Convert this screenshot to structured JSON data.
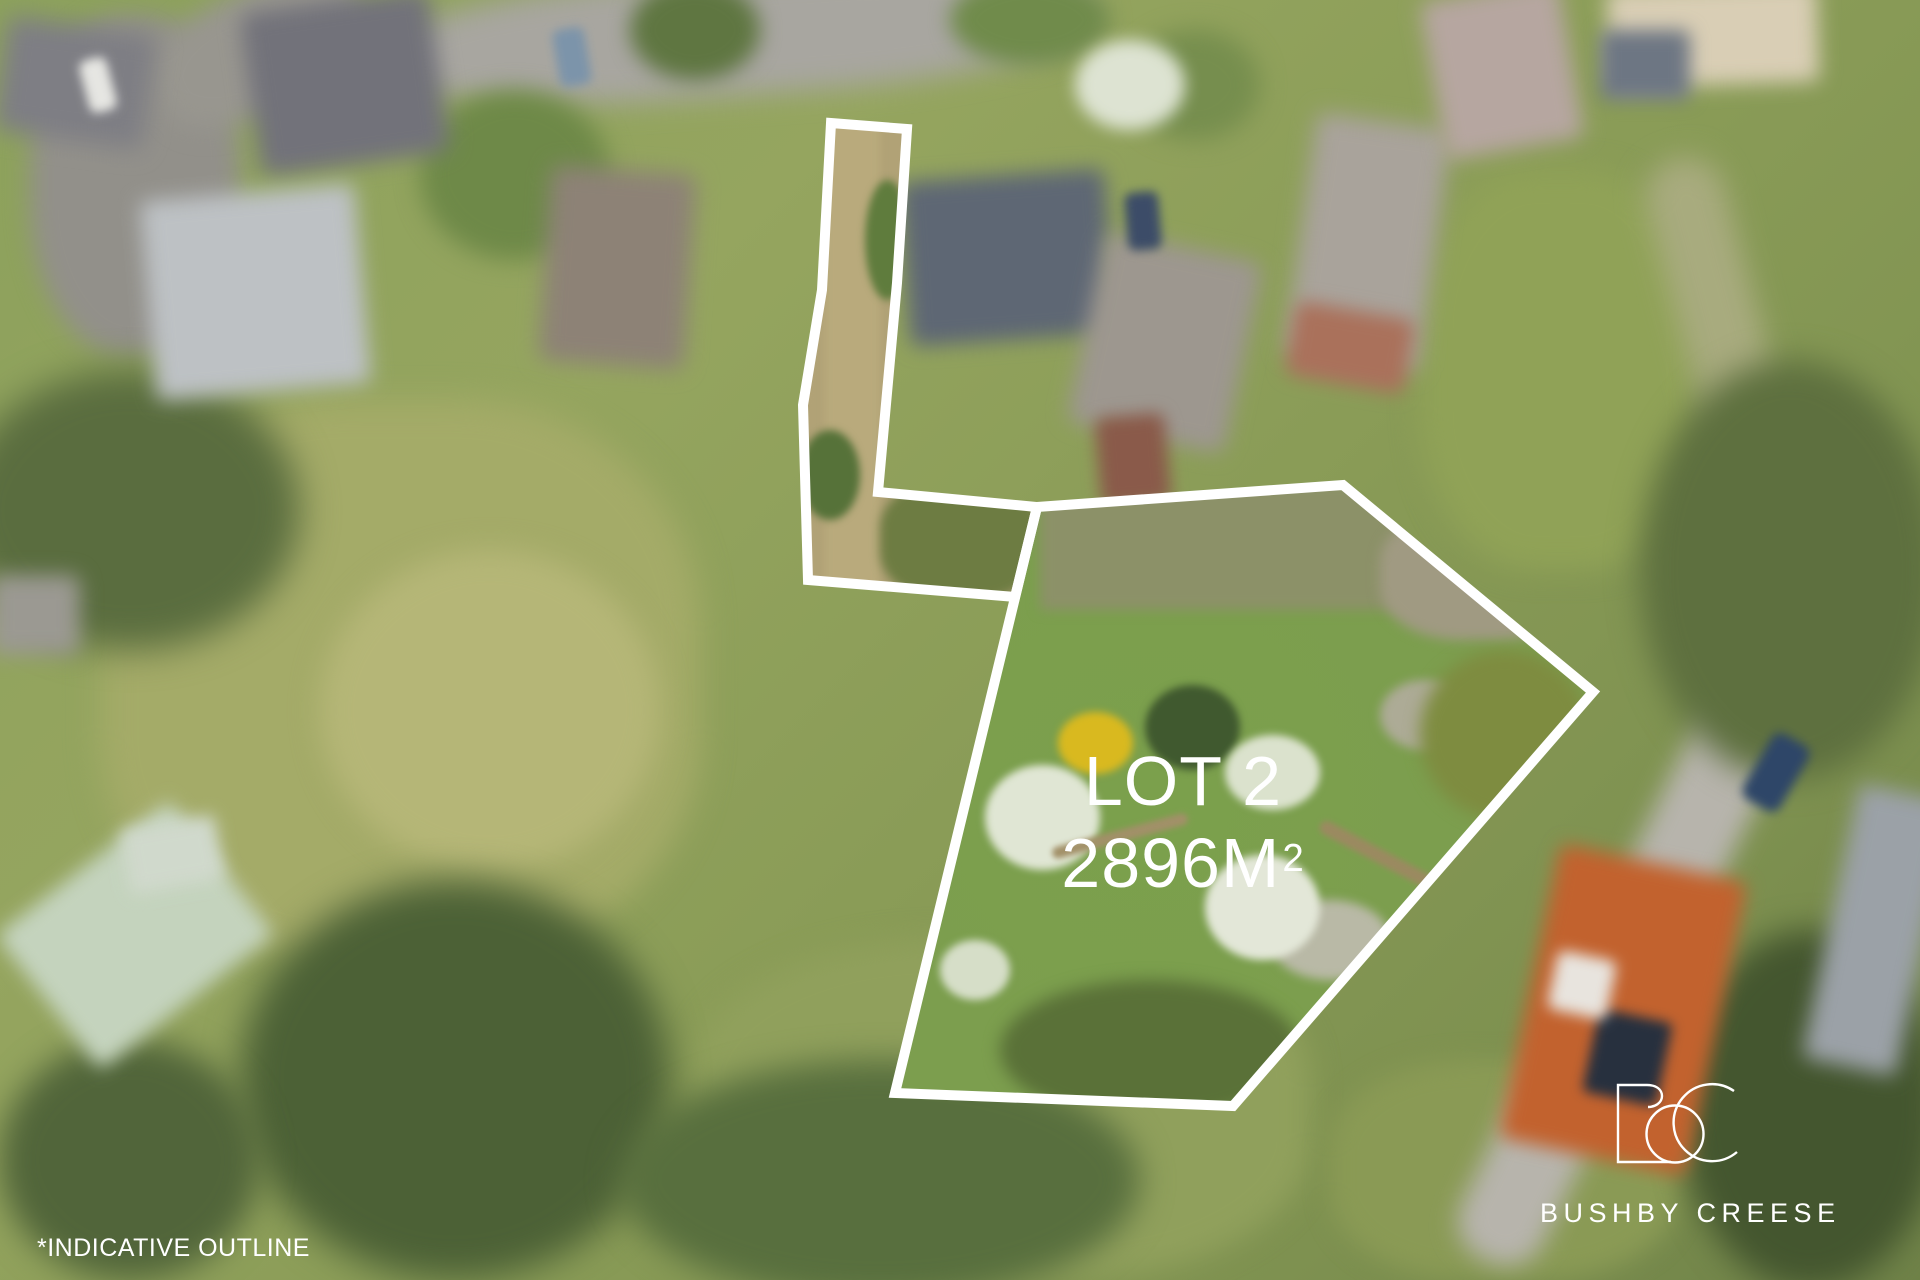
{
  "overlay": {
    "lot_label": "LOT 2",
    "area_main": "2896M",
    "area_sup": "2",
    "footnote": "*INDICATIVE OUTLINE",
    "outline_color": "#ffffff",
    "text_color": "#ffffff"
  },
  "branding": {
    "logo_icon": "bc-monogram-icon",
    "monogram": "BC",
    "name": "BUSHBY CREESE",
    "color": "#ffffff"
  }
}
